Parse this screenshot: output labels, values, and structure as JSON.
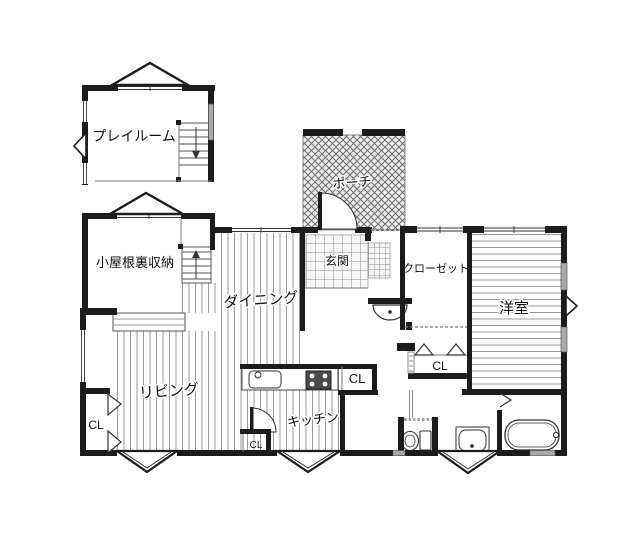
{
  "plan": {
    "rooms": {
      "playroom": {
        "label": "プレイルーム"
      },
      "attic_storage": {
        "label": "小屋根裏収納"
      },
      "dining": {
        "label": "ダイニング"
      },
      "living": {
        "label": "リビング"
      },
      "kitchen": {
        "label": "キッチン"
      },
      "porch": {
        "label": "ポーチ"
      },
      "entrance": {
        "label": "玄関"
      },
      "closet": {
        "label": "クローゼット"
      },
      "western_room": {
        "label": "洋室"
      }
    },
    "closet_labels": {
      "living_cl": "CL",
      "kitchen_counter_cl": "CL",
      "kitchen_floor_cl": "CL",
      "hall_cl": "CL"
    },
    "colors": {
      "wall": "#1c1c1c",
      "floor_stripe": "#9a9a9a",
      "tile_line": "#8f8f8f",
      "hatch": "#6e6e6e",
      "window_gray": "#aaaaaa"
    }
  }
}
